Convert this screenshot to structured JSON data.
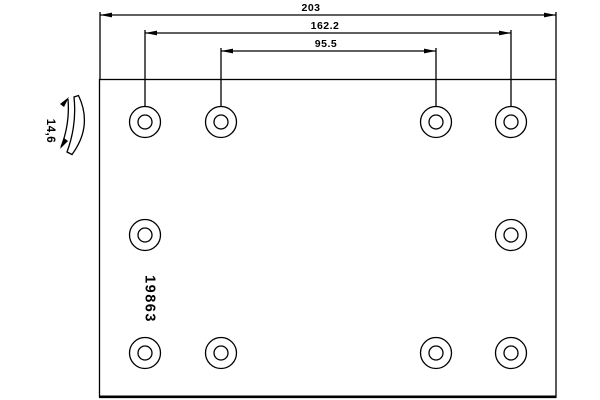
{
  "drawing": {
    "labels": {
      "total_length": "203",
      "outer_hole_spacing": "162.2",
      "inner_hole_spacing": "95.5",
      "thickness": "14,6",
      "part_number": "19863"
    },
    "holes": {
      "count": 10,
      "rows": 3,
      "top_row": 4,
      "middle_row": 2,
      "bottom_row": 4
    },
    "colors": {
      "line": "#000000",
      "background": "#ffffff"
    }
  }
}
